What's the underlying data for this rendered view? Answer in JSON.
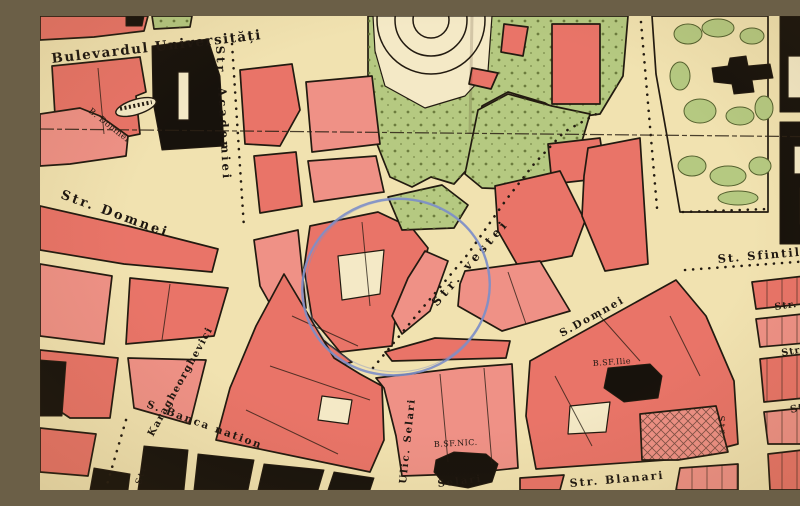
{
  "title": "Historical city map sheet (central Bucharest) with hand-drawn blue circle annotation",
  "colors": {
    "paper": "#f1e2b0",
    "paper_light": "#f4e9c6",
    "building_red": "#e97468",
    "building_red_light": "#ef9186",
    "park_green": "#b5c981",
    "tree_dot": "#5f6e33",
    "ink": "#221a10",
    "black_building": "#17120c",
    "annotation_blue": "#7d8fc9"
  },
  "labels": [
    {
      "id": "bd-universitatii",
      "text": "Bulevardul Universități",
      "x": 12,
      "y": 47,
      "r": -6.5,
      "s": 13.5,
      "w": 700,
      "ls": 1.5
    },
    {
      "id": "str-academiei",
      "text": "Str. Academiei",
      "x": 176,
      "y": 30,
      "r": 87,
      "s": 11.5,
      "w": 700,
      "ls": 3
    },
    {
      "id": "b-domnei",
      "text": "B. Domnei",
      "x": 48,
      "y": 96,
      "r": 38,
      "s": 8.5,
      "w": 400,
      "ls": 0.5
    },
    {
      "id": "str-domnei",
      "text": "Str. Domnei",
      "x": 20,
      "y": 182,
      "r": 20,
      "s": 13,
      "w": 700,
      "ls": 2.5
    },
    {
      "id": "karagheorghevici",
      "text": "Karagheorghevici",
      "x": 113,
      "y": 421,
      "r": -61,
      "s": 10,
      "w": 700,
      "ls": 1.5
    },
    {
      "id": "banca-nationala",
      "text": "S. Banca nation",
      "x": 106,
      "y": 391,
      "r": 20,
      "s": 10.5,
      "w": 700,
      "ls": 2
    },
    {
      "id": "str-bl-vertical",
      "text": "Str.",
      "x": 101,
      "y": 469,
      "r": -73,
      "s": 9,
      "w": 400,
      "ls": 2
    },
    {
      "id": "ulic-selari",
      "text": "Ulic. Selari",
      "x": 366,
      "y": 468,
      "r": -84,
      "s": 10,
      "w": 700,
      "ls": 2
    },
    {
      "id": "selari",
      "text": "Selari",
      "x": 398,
      "y": 471,
      "r": -7,
      "s": 10,
      "w": 700,
      "ls": 2
    },
    {
      "id": "b-sf-nic",
      "text": "B.SF.NIC.",
      "x": 394,
      "y": 431,
      "r": -3,
      "s": 8,
      "w": 400,
      "ls": 0.5
    },
    {
      "id": "str-vestei",
      "text": "Str. vestei",
      "x": 397,
      "y": 291,
      "r": -49,
      "s": 12,
      "w": 700,
      "ls": 4
    },
    {
      "id": "s-domnei-east",
      "text": "S.Domnei",
      "x": 522,
      "y": 321,
      "r": -29,
      "s": 10.5,
      "w": 700,
      "ls": 2
    },
    {
      "id": "b-sf-ilie",
      "text": "B.SF.Ilie",
      "x": 553,
      "y": 350,
      "r": -4,
      "s": 8,
      "w": 400,
      "ls": 0.5
    },
    {
      "id": "str-blanari",
      "text": "Str. Blanari",
      "x": 530,
      "y": 471,
      "r": -5,
      "s": 11,
      "w": 700,
      "ls": 2
    },
    {
      "id": "st-sfintilor",
      "text": "St. Sfintilor",
      "x": 678,
      "y": 247,
      "r": -5,
      "s": 11.5,
      "w": 700,
      "ls": 2
    },
    {
      "id": "str-basa",
      "text": "Str. Basa",
      "x": 735,
      "y": 294,
      "r": -8,
      "s": 9.5,
      "w": 700,
      "ls": 1
    },
    {
      "id": "str-pe",
      "text": "Str. Pe",
      "x": 742,
      "y": 340,
      "r": -10,
      "s": 9.5,
      "w": 700,
      "ls": 1
    },
    {
      "id": "str-right",
      "text": "Str.",
      "x": 751,
      "y": 397,
      "r": -13,
      "s": 10,
      "w": 700,
      "ls": 1
    },
    {
      "id": "str-br-vertical",
      "text": "Str",
      "x": 678,
      "y": 400,
      "r": 84,
      "s": 9,
      "w": 400,
      "ls": 2
    }
  ],
  "annotation": {
    "type": "ellipse",
    "cx": 356,
    "cy": 271,
    "rx": 94,
    "ry": 88,
    "rotate": -12
  },
  "fold_line": {
    "d": "M0,113 L800,121"
  },
  "crease_line": {
    "d": "M432,0 L430,118"
  },
  "map": {
    "blocks": [
      {
        "n": "green-top-left-a",
        "f": "green",
        "p": "0,0 34,0 32,11 0,13"
      },
      {
        "n": "green-top-left-b",
        "f": "green",
        "p": "112,0 152,0 150,11 114,13"
      },
      {
        "n": "red-top-strip",
        "f": "red",
        "p": "0,0 108,0 104,15 54,21 0,24"
      },
      {
        "n": "black-top-small",
        "f": "black",
        "p": "86,0 104,0 102,10 86,10"
      },
      {
        "n": "park-main",
        "f": "green",
        "p": "328,0 588,0 583,60 560,98 530,102 505,87 468,76 442,90 432,148 414,168 391,161 372,171 350,161 337,128 328,60"
      },
      {
        "n": "park-ring-clearing",
        "f": "cream",
        "p": "333,0 452,0 448,55 425,80 385,92 345,70 335,35"
      },
      {
        "n": "park-east",
        "f": "green",
        "p": "425,158 438,94 468,78 512,90 550,98 540,132 500,166 468,173 442,172"
      },
      {
        "n": "garden-monument",
        "f": "paper",
        "p": "612,0 728,0 728,196 640,196 627,120 616,58"
      },
      {
        "n": "block-west-a",
        "f": "red",
        "p": "12,50 100,41 106,76 96,80 100,118 60,126 16,116"
      },
      {
        "n": "block-west-b",
        "f": "red2",
        "p": "0,98 40,92 60,100 88,120 86,140 30,148 0,150"
      },
      {
        "n": "university-black",
        "f": "black",
        "p": "112,30 168,23 180,60 184,130 122,134 113,86"
      },
      {
        "n": "university-court",
        "f": "cream",
        "p": "138,56 149,56 149,104 138,104"
      },
      {
        "n": "block-academiei-e1",
        "f": "red",
        "p": "200,54 252,48 260,94 240,130 205,128"
      },
      {
        "n": "block-academiei-e2",
        "f": "red2",
        "p": "266,66 332,60 340,128 272,136"
      },
      {
        "n": "block-academiei-e3",
        "f": "red",
        "p": "214,140 256,136 262,190 220,197"
      },
      {
        "n": "block-academiei-e4",
        "f": "red2",
        "p": "268,145 336,140 344,176 274,186"
      },
      {
        "n": "park-building-large",
        "f": "red",
        "p": "512,8 560,8 560,88 512,88"
      },
      {
        "n": "park-building-b",
        "f": "red",
        "p": "464,8 488,11 483,40 461,36"
      },
      {
        "n": "park-building-c",
        "f": "red",
        "p": "432,52 458,57 451,73 429,68"
      },
      {
        "n": "block-e4-red",
        "f": "red",
        "p": "508,128 560,122 566,162 512,168"
      },
      {
        "n": "block-d1",
        "f": "red",
        "p": "0,190 88,210 178,233 172,256 84,248 0,234"
      },
      {
        "n": "block-d2",
        "f": "red2",
        "p": "0,248 72,260 64,328 0,320"
      },
      {
        "n": "block-d3",
        "f": "red",
        "p": "90,262 188,272 174,320 86,328"
      },
      {
        "n": "block-d4",
        "f": "red",
        "p": "0,334 78,342 70,402 30,402 0,382"
      },
      {
        "n": "block-d4-black",
        "f": "black",
        "p": "0,344 26,346 22,400 0,400"
      },
      {
        "n": "block-d5",
        "f": "red2",
        "p": "88,342 166,344 150,408 94,392"
      },
      {
        "n": "block-d6",
        "f": "red",
        "p": "0,412 56,418 48,460 0,456"
      },
      {
        "n": "corner-black-sw",
        "f": "black",
        "p": "54,452 90,458 88,474 50,474"
      },
      {
        "n": "central-complex",
        "f": "red",
        "p": "270,210 338,196 372,212 388,232 378,270 355,305 352,330 300,336 272,302 264,252"
      },
      {
        "n": "central-court",
        "f": "cream",
        "p": "298,240 344,234 340,278 302,284"
      },
      {
        "n": "block-c2",
        "f": "red2",
        "p": "214,224 258,214 266,292 238,302 220,270"
      },
      {
        "n": "block-c3",
        "f": "red",
        "p": "262,308 312,346 292,352 256,328"
      },
      {
        "n": "block-c4",
        "f": "red2",
        "p": "385,235 408,245 390,295 362,318 352,300 368,262"
      },
      {
        "n": "green-patch-circle",
        "f": "green",
        "p": "348,181 402,169 428,189 414,212 362,214"
      },
      {
        "n": "block-m1",
        "f": "red",
        "p": "244,258 294,342 320,358 342,370 344,424 330,456 176,424 190,372 216,310",
        "o": "none"
      },
      {
        "n": "block-m1-court",
        "f": "cream",
        "p": "282,380 312,384 308,408 278,404"
      },
      {
        "n": "block-e1",
        "f": "red",
        "p": "455,170 520,155 545,205 532,240 478,250 458,215"
      },
      {
        "n": "block-e2",
        "f": "red2",
        "p": "425,255 500,245 530,295 462,315 418,290 420,268"
      },
      {
        "n": "block-e3",
        "f": "red",
        "p": "548,132 600,122 608,248 565,255 542,200 544,160"
      },
      {
        "n": "block-e5",
        "f": "red",
        "p": "395,322 470,325 466,342 352,345 345,336"
      },
      {
        "n": "block-g1",
        "f": "red",
        "p": "490,345 636,264 666,300 694,365 698,428 640,443 496,453 486,400"
      },
      {
        "n": "block-g1-court",
        "f": "cream",
        "p": "530,390 570,386 566,416 528,418"
      },
      {
        "n": "block-g1-hatch",
        "f": "red2",
        "p": "600,398 676,390 688,436 638,444 602,444",
        "o": "xh"
      },
      {
        "n": "block-g2",
        "f": "red2",
        "p": "336,362 420,352 472,348 478,452 420,458 362,460 356,420 344,372"
      },
      {
        "n": "black-ne-1",
        "f": "black",
        "p": "740,0 800,0 800,96 740,96"
      },
      {
        "n": "black-ne-1-court",
        "f": "cream",
        "p": "748,40 778,40 778,82 748,82"
      },
      {
        "n": "black-ne-green-court",
        "f": "green",
        "p": "770,12 796,12 796,32 770,32"
      },
      {
        "n": "black-ne-2",
        "f": "black",
        "p": "740,106 800,106 800,228 740,228"
      },
      {
        "n": "black-ne-2-court-a",
        "f": "cream",
        "p": "754,130 782,130 782,158 754,158"
      },
      {
        "n": "black-ne-2-court-b",
        "f": "cream",
        "p": "760,172 786,172 786,208 760,208"
      },
      {
        "n": "block-r1",
        "f": "red",
        "p": "712,266 800,256 800,284 716,293",
        "o": "pv"
      },
      {
        "n": "block-r2",
        "f": "red2",
        "p": "716,303 800,294 800,324 720,331",
        "o": "pv"
      },
      {
        "n": "block-r3",
        "f": "red",
        "p": "720,343 800,334 800,378 785,380 724,386",
        "o": "pv"
      },
      {
        "n": "block-r4",
        "f": "red2",
        "p": "724,396 783,390 780,428 728,428",
        "o": "pv"
      },
      {
        "n": "block-r5",
        "f": "red",
        "p": "728,438 780,432 776,474 730,474",
        "o": "pv"
      },
      {
        "n": "green-br-strip",
        "f": "green",
        "p": "786,398 800,396 800,474 788,474"
      },
      {
        "n": "block-bb1a",
        "f": "red",
        "p": "480,462 524,459 520,474 480,474"
      },
      {
        "n": "block-bb1b",
        "f": "red2",
        "p": "640,452 698,448 698,474 636,474",
        "o": "pv"
      },
      {
        "n": "bank-black-1",
        "f": "black",
        "p": "104,430 148,434 144,474 98,474"
      },
      {
        "n": "bank-black-2",
        "f": "black",
        "p": "158,438 214,444 208,474 154,474"
      },
      {
        "n": "bank-black-3",
        "f": "black",
        "p": "224,448 284,454 278,474 218,474"
      },
      {
        "n": "bank-black-4",
        "f": "black",
        "p": "294,456 334,462 330,474 288,474"
      },
      {
        "n": "church-sf-nicolae",
        "f": "black",
        "p": "396,444 414,436 446,438 458,448 452,466 428,472 404,468 394,456"
      },
      {
        "n": "church-sf-ilie",
        "f": "black",
        "p": "568,352 610,348 622,360 618,382 584,386 564,372"
      },
      {
        "n": "monument-cross",
        "f": "black",
        "p": "672,52 688,50 690,42 706,40 708,50 730,48 733,62 712,64 714,76 694,78 692,68 674,66"
      }
    ],
    "garden_blobs": [
      [
        648,
        18,
        14,
        10
      ],
      [
        678,
        12,
        16,
        9
      ],
      [
        712,
        20,
        12,
        8
      ],
      [
        640,
        60,
        10,
        14
      ],
      [
        660,
        95,
        16,
        12
      ],
      [
        700,
        100,
        14,
        9
      ],
      [
        724,
        92,
        9,
        12
      ],
      [
        652,
        150,
        14,
        10
      ],
      [
        688,
        160,
        18,
        10
      ],
      [
        720,
        150,
        11,
        9
      ],
      [
        698,
        182,
        20,
        7
      ]
    ],
    "monument_oval": {
      "cx": 96,
      "cy": 91,
      "rx": 21,
      "ry": 7.5,
      "rotate": -17
    },
    "ring_feature": {
      "cx": 391,
      "cy": 4,
      "radii": [
        54,
        36,
        18
      ]
    },
    "dot_rows": [
      "M601,6 L617,192",
      "M643,196 L728,193",
      "M645,254 L798,243",
      "M86,404 L66,472",
      "M333,352 L380,295 L428,238 L466,184 L494,148 L524,116 L560,96",
      "M192,28 L204,212"
    ],
    "inner_lines": [
      "M252,300 L318,330",
      "M230,350 L330,384",
      "M206,394 L298,438",
      "M322,206 L330,290",
      "M560,300 L600,345",
      "M515,360 L552,430",
      "M630,300 L660,360",
      "M400,358 L408,446",
      "M444,352 L452,448",
      "M468,256 L486,308",
      "M130,268 L122,324",
      "M58,52 L64,118"
    ]
  }
}
